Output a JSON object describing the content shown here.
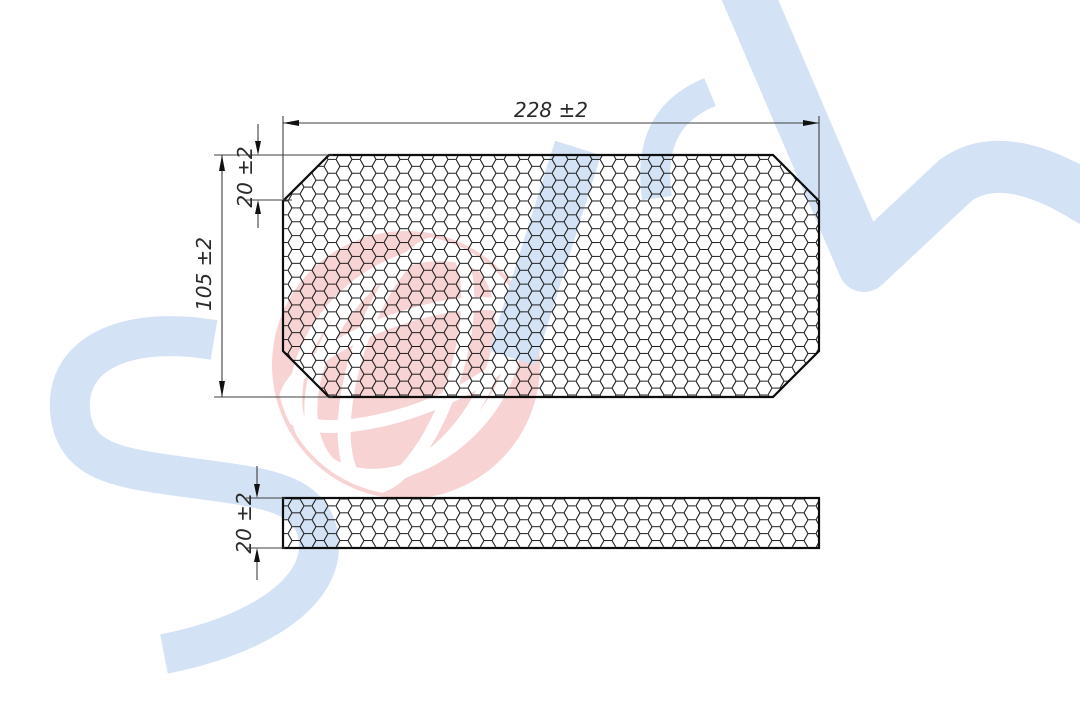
{
  "drawing": {
    "view_top": {
      "width_label": "228 ±2",
      "height_label": "105 ±2",
      "chamfer_label": "20 ±2"
    },
    "view_side": {
      "thickness_label": "20 ±2"
    }
  },
  "style": {
    "watermark_blue": "#d3e3f5",
    "globe_pink": "#f8d3d3",
    "globe_line_white": "#ffffff",
    "mesh_ink": "#1d1d1d",
    "outline_ink": "#0d0d0d",
    "dim_line_color": "#3f3f3f",
    "text_color": "#2a2a2a",
    "background": "#ffffff"
  }
}
